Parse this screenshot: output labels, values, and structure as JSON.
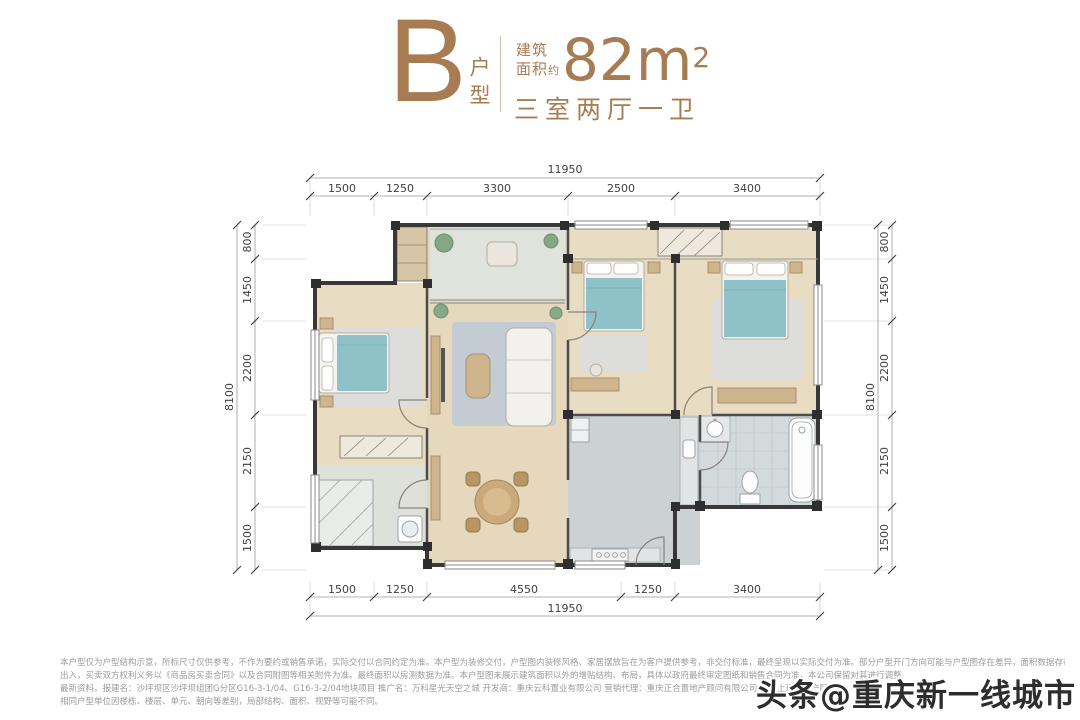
{
  "header": {
    "type_letter": "B",
    "type_label": "户型",
    "area_label_l1": "建筑",
    "area_label_l2": "面积",
    "area_approx": "约",
    "area_value": "82m",
    "area_exponent": "2",
    "layout_label": "三室两厅一卫",
    "accent_color": "#a87c52"
  },
  "dimensions": {
    "unit": "mm",
    "top": {
      "total": "11950",
      "segments": [
        "1500",
        "1250",
        "3300",
        "2500",
        "3400"
      ]
    },
    "bottom": {
      "total": "11950",
      "segments": [
        "1500",
        "1250",
        "4550",
        "1250",
        "3400"
      ]
    },
    "left": {
      "total": "8100",
      "segments": [
        "800",
        "1450",
        "2200",
        "2150",
        "1500"
      ]
    },
    "right": {
      "total": "8100",
      "segments": [
        "800",
        "1450",
        "2200",
        "2150",
        "1500"
      ]
    }
  },
  "disclaimer": {
    "line1": "本户型仅为户型结构示意，所标尺寸仅供参考，不作为要约或销售承诺，实际交付以合同约定为准。本户型为装修交付，户型图内装修风格、家居摆放旨在为客户提供参考，非交付标准，最终呈现以实际交付为准。部分户型开门方向可能与户型图存在差异，面积数据存在",
    "line2": "出入，买卖双方权利义务以《商品房买卖合同》以及合同附图等相关附件为准。最终面积以房测数据为准。本户型图未展示建筑面积以外的增贴结构、布局，具体以政府最终审定图纸和销售合同为准，本公司保留对其进行调整",
    "line3": "最新资料。报建名：沙坪坝区沙坪坝组团G分区G16-3-1/04、G16-3-2/04地块项目 推广名：万科星光天空之城 开发商：重庆云科置业有限公司 营销代理：重庆正合置地产顾问有限公司/重庆上瑞房地产顾",
    "line4": "相同户型单位因楼栋、楼层、单元、朝向等差别，局部结构、面积、视野等可能不同。"
  },
  "watermark": {
    "text": "头条@重庆新一线城市"
  }
}
